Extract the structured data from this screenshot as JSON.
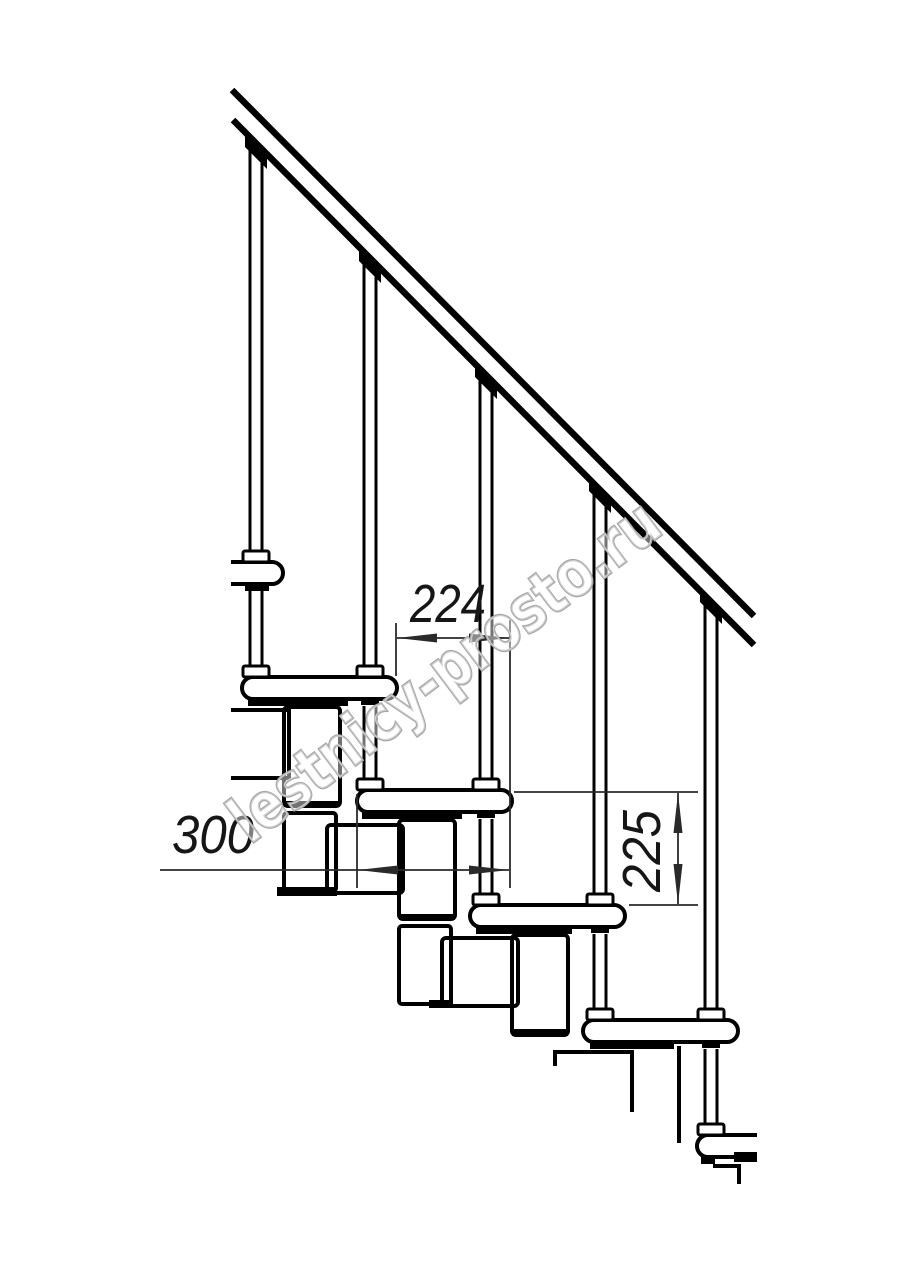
{
  "drawing": {
    "title": "Modular staircase side-view technical drawing",
    "watermark_text": "lestnicy-prosto.ru",
    "line_color": "#000000",
    "dim_line_color": "#2a2a2a",
    "watermark_color": "#a8a8a8"
  },
  "dimensions": {
    "step_run": {
      "label": "224"
    },
    "tread_depth": {
      "label": "300"
    },
    "step_rise": {
      "label": "225"
    }
  }
}
